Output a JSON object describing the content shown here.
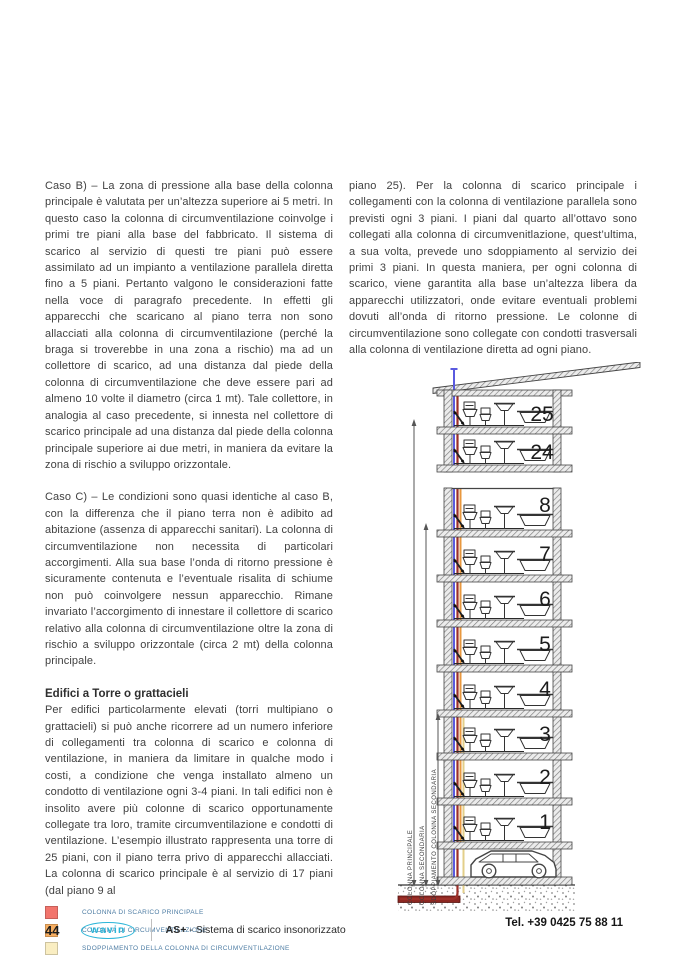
{
  "left_column": {
    "para_caso_b": "Caso B) – La zona di pressione alla base della colonna principale è valutata per un’altezza superiore ai 5 metri. In questo caso la colonna di circumventilazione coinvolge i primi tre piani alla base del fabbricato. Il sistema di scarico al servizio di questi tre piani può essere assimilato ad un impianto a ventilazione parallela diretta fino a 5 piani. Pertanto valgono le considerazioni fatte nella voce di paragrafo precedente. In effetti gli apparecchi che scaricano al piano terra non sono allacciati alla colonna di circumventilazione  (perché la braga si troverebbe in una zona a rischio) ma ad un collettore di scarico, ad una distanza dal piede della colonna di circumventilazione  che deve essere pari ad almeno 10 volte il diametro (circa 1 mt). Tale collettore, in analogia al caso precedente, si innesta nel collettore di scarico principale ad una distanza dal piede della colonna principale superiore ai due metri, in maniera da evitare la zona di rischio a sviluppo orizzontale.",
    "para_caso_c": "Caso C) – Le condizioni sono quasi identiche al caso B, con la differenza che il piano terra non è adibito ad abitazione (assenza di apparecchi sanitari). La colonna di circumventilazione non necessita di particolari accorgimenti. Alla sua base l’onda di ritorno pressione è sicuramente contenuta e l’eventuale risalita di schiume non può coinvolgere nessun apparecchio. Rimane invariato l’accorgimento di innestare il collettore di scarico relativo alla colonna di circumventilazione oltre la zona di rischio a sviluppo orizzontale (circa 2 mt) della colonna principale.",
    "heading": "Edifici a Torre o grattacieli",
    "para_torre": "Per edifici particolarmente elevati (torri multipiano o grattacieli) si può anche ricorrere ad un numero inferiore di collegamenti tra colonna di scarico e colonna di ventilazione, in maniera da limitare in qualche modo i costi, a condizione che venga installato almeno un condotto di ventilazione ogni 3-4 piani. In tali edifici non è insolito avere più colonne di scarico opportunamente collegate tra loro, tramite circumventilazione e condotti di ventilazione. L’esempio illustrato rappresenta una torre di 25 piani, con il piano terra privo di apparecchi allacciati. La colonna di scarico principale è al servizio di 17 piani (dal piano 9 al"
  },
  "right_column": {
    "para_piano25": "piano 25). Per la colonna di scarico principale i collegamenti con la colonna di ventilazione parallela sono previsti ogni 3 piani. I piani dal quarto all’ottavo sono collegati alla colonna di circumvenitlazione, quest’ultima, a sua volta, prevede uno sdoppiamento al servizio dei primi 3 piani. In questa maniera, per ogni colonna di scarico, viene garantita alla base un’altezza libera da apparecchi utilizzatori, onde evitare eventuali problemi dovuti all’onda di ritorno pressione. Le colonne di circumventilazione sono collegate con condotti trasversali alla colonna di ventilazione diretta ad ogni piano."
  },
  "legend": {
    "items": [
      {
        "label": "COLONNA DI SCARICO PRINCIPALE",
        "color": "#f2756d"
      },
      {
        "label": "COLONNA DI CIRCUMVENTILAZIONE",
        "color": "#f6ae61"
      },
      {
        "label": "SDOPPIAMENTO DELLA COLONNA DI CIRCUMVENTILAZIONE",
        "color": "#faeec2"
      },
      {
        "label": "SFIATO AL TETTO, COLONNA E CONDOTTI DI VENTILAZIONE PRINCIPALE",
        "color": "#7b74e5"
      }
    ]
  },
  "diagram": {
    "floor_labels": [
      "25",
      "24",
      "8",
      "7",
      "6",
      "5",
      "4",
      "3",
      "2",
      "1"
    ],
    "column_labels": [
      "COLONNA PRINCIPALE",
      "COLONNA SECONDARIA",
      "SDOPPIAMENTO COLONNA SECONDARIA"
    ],
    "pipe_colors": {
      "ventilazione": "#5a5adf",
      "scarico": "#9c2f28",
      "circumventilazione": "#e8983f",
      "sdoppiamento": "#e3cf8a",
      "collettore": "#8c2722"
    }
  },
  "footer": {
    "page_number": "44",
    "brand": "wavin",
    "product": "AS+",
    "subtitle": " - Sistema di scarico insonorizzato",
    "phone": "Tel. +39 0425 75 88 11"
  }
}
